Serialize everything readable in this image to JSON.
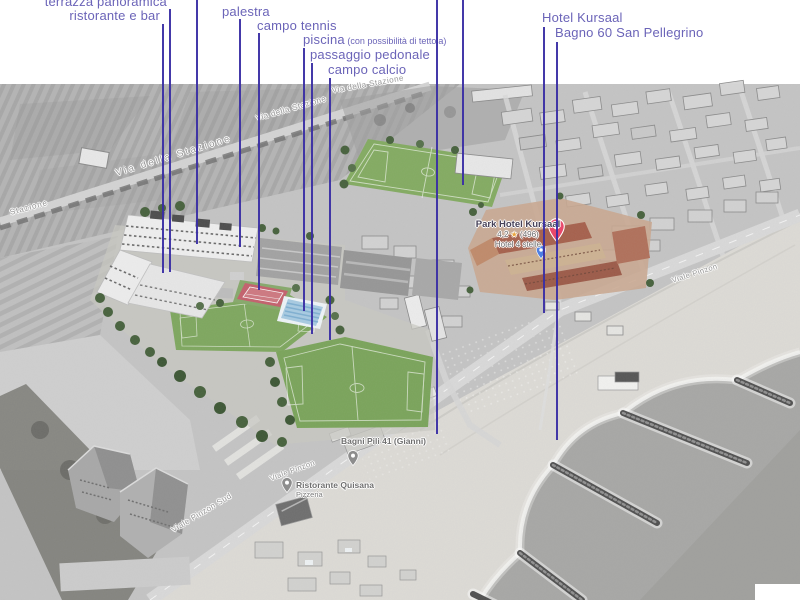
{
  "colors": {
    "annotation_label": "#6b64b8",
    "annotation_line": "#3a2ea4",
    "street_gray": "#979797",
    "poi_gray": "#6f6f6f",
    "poi_pin_gray": "#8d8d8d",
    "hotel_pin_red": "#e8486b",
    "location_pin_blue": "#4d7fe3"
  },
  "annotations": {
    "items": [
      {
        "id": "terrazza-panoramica",
        "label": "terrazza panoramica",
        "align": "right",
        "x_text": 167,
        "y_text": -5,
        "x_line": 170,
        "y1": 9,
        "y2": 272
      },
      {
        "id": "ristorante-bar",
        "label": "ristorante e bar",
        "align": "right",
        "x_text": 160,
        "y_text": 9,
        "x_line": 163,
        "y1": 24,
        "y2": 273
      },
      {
        "id": "cropped-1",
        "label": "",
        "x_line": 197,
        "y1": 0,
        "y2": 244
      },
      {
        "id": "palestra",
        "label": "palestra",
        "align": "left",
        "x_text": 222,
        "y_text": 5,
        "x_line": 240,
        "y1": 19,
        "y2": 247
      },
      {
        "id": "campo-tennis",
        "label": "campo tennis",
        "align": "left",
        "x_text": 257,
        "y_text": 19,
        "x_line": 259,
        "y1": 33,
        "y2": 290
      },
      {
        "id": "piscina",
        "label": "piscina",
        "sub": " (con possibilità di tettoia)",
        "align": "left",
        "x_text": 303,
        "y_text": 33,
        "x_line": 304,
        "y1": 48,
        "y2": 311
      },
      {
        "id": "passaggio-pedonale",
        "label": "passaggio pedonale",
        "align": "left",
        "x_text": 310,
        "y_text": 48,
        "x_line": 312,
        "y1": 63,
        "y2": 334
      },
      {
        "id": "campo-calcio",
        "label": "campo calcio",
        "align": "left",
        "x_text": 328,
        "y_text": 63,
        "x_line": 330,
        "y1": 78,
        "y2": 340
      },
      {
        "id": "cropped-2",
        "label": "",
        "x_line": 437,
        "y1": 0,
        "y2": 434
      },
      {
        "id": "cropped-3",
        "label": "",
        "x_line": 463,
        "y1": 0,
        "y2": 185
      },
      {
        "id": "hotel-kursaal",
        "label": "Hotel Kursaal",
        "align": "left",
        "x_text": 542,
        "y_text": 11,
        "x_line": 544,
        "y1": 27,
        "y2": 313
      },
      {
        "id": "bagno-60",
        "label": "Bagno 60 San Pellegrino",
        "align": "left",
        "x_text": 555,
        "y_text": 26,
        "x_line": 557,
        "y1": 42,
        "y2": 440
      }
    ]
  },
  "map": {
    "streets": [
      {
        "text": "Via della Stazione",
        "x": 116,
        "y": 168,
        "rot": -17,
        "size": 9.5,
        "ls": 2.5
      },
      {
        "text": "Stazione",
        "x": 10,
        "y": 208,
        "rot": -15,
        "size": 8,
        "ls": 1
      },
      {
        "text": "Via della Stazione",
        "x": 256,
        "y": 114,
        "rot": -16,
        "size": 8,
        "ls": 0.5
      },
      {
        "text": "Via della Stazione",
        "x": 332,
        "y": 86,
        "rot": -10,
        "size": 8,
        "ls": 0.5
      },
      {
        "text": "Viale Pinzon Sud",
        "x": 172,
        "y": 526,
        "rot": -31,
        "size": 8,
        "ls": 0.5
      },
      {
        "text": "Viale Pinzon",
        "x": 270,
        "y": 474,
        "rot": -20,
        "size": 7.5,
        "ls": 0.5
      },
      {
        "text": "Viale Pinzon",
        "x": 672,
        "y": 276,
        "rot": -18,
        "size": 7.5,
        "ls": 0.5
      }
    ],
    "pois": [
      {
        "name": "Bagni Pili 41 (Gianni)",
        "x": 341,
        "y": 437,
        "pin_x": 347,
        "pin_y": 450
      },
      {
        "name": "Ristorante Quisana",
        "sub": "Pizzeria",
        "x": 296,
        "y": 481,
        "pin_x": 281,
        "pin_y": 477
      }
    ],
    "hotel_label": {
      "name": "Park Hotel Kursaal",
      "rating_value": "4,2",
      "star": "★",
      "rating_count": "(496)",
      "category": "Hotel 4 stelle",
      "cx": 518,
      "name_y": 219,
      "rating_y": 231,
      "category_y": 242,
      "red_pin": {
        "x": 556,
        "y": 242
      },
      "blue_pin": {
        "x": 541,
        "y": 259
      }
    }
  }
}
